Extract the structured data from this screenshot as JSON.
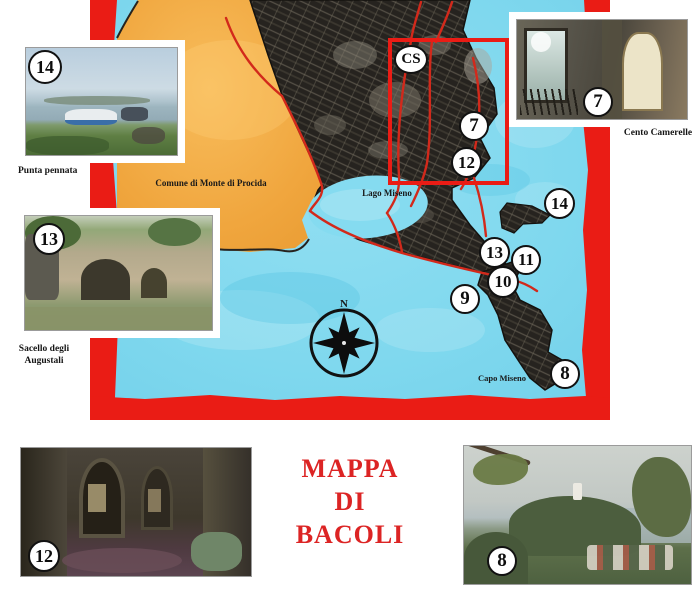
{
  "title": {
    "line1": "MAPPA",
    "line2": "DI",
    "line3": "BACOLI"
  },
  "map": {
    "region_labels": {
      "comune": "Comune di Monte di Procida",
      "lago": "Lago Miseno",
      "capo": "Capo Miseno"
    },
    "compass": {
      "north_label": "N"
    },
    "markers": [
      {
        "id": "cs",
        "label": "CS"
      },
      {
        "id": "7",
        "label": "7"
      },
      {
        "id": "12",
        "label": "12"
      },
      {
        "id": "14",
        "label": "14"
      },
      {
        "id": "13",
        "label": "13"
      },
      {
        "id": "11",
        "label": "11"
      },
      {
        "id": "10",
        "label": "10"
      },
      {
        "id": "9",
        "label": "9"
      },
      {
        "id": "8",
        "label": "8"
      }
    ]
  },
  "photos": [
    {
      "id": "punta-pennata",
      "number": "14",
      "caption": "Punta pennata"
    },
    {
      "id": "sacello-degli-augustali",
      "number": "13",
      "caption_line1": "Sacello degli",
      "caption_line2": "Augustali"
    },
    {
      "id": "cento-camerelle",
      "number": "7",
      "caption": "Cento Camerelle"
    },
    {
      "id": "cistern-interior",
      "number": "12"
    },
    {
      "id": "capo-miseno-hillside",
      "number": "8"
    }
  ],
  "colors": {
    "border_red": "#ea1c15",
    "road_red": "#d2291b",
    "sea_blue": "#7fd8ee",
    "land_orange": "#f0a63e",
    "urban_dark": "#26231f",
    "title_red": "#dc2424",
    "badge_bg": "#ffffff",
    "badge_border": "#111111"
  }
}
